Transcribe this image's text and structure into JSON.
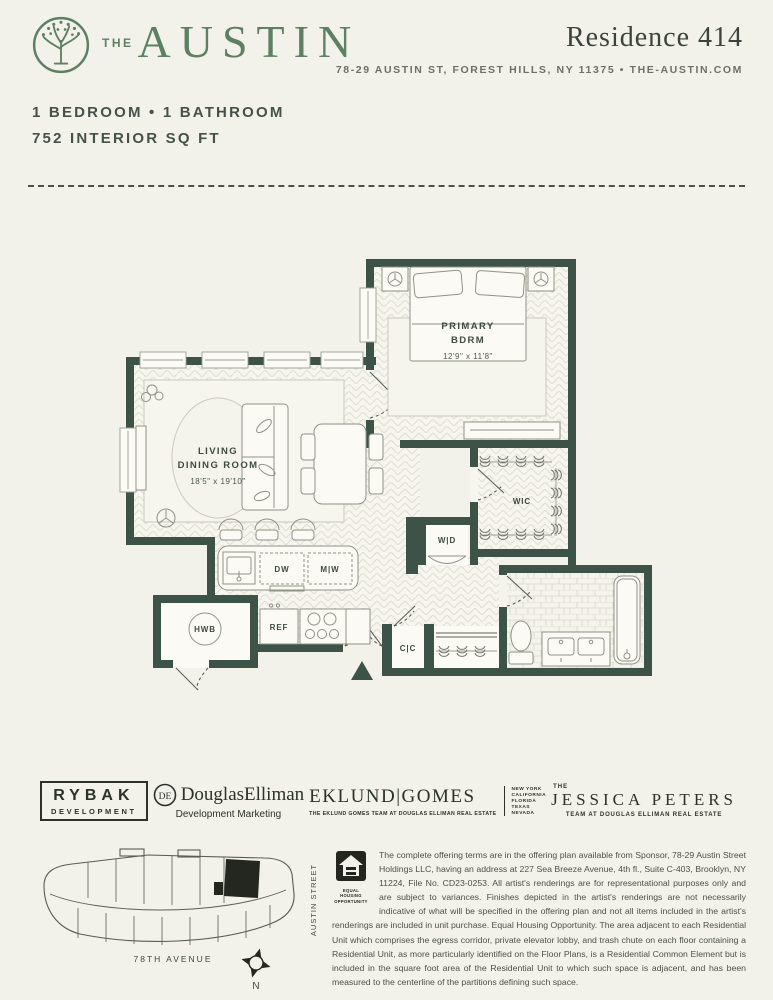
{
  "header": {
    "brand_the": "THE",
    "brand_name": "AUSTIN",
    "residence_title": "Residence 414",
    "address_line": "78-29 AUSTIN ST, FOREST HILLS, NY 11375 • THE-AUSTIN.COM"
  },
  "unit_summary": {
    "beds_baths": "1 BEDROOM  •  1 BATHROOM",
    "area": "752 INTERIOR SQ FT"
  },
  "floorplan": {
    "living_line1": "LIVING",
    "living_line2": "DINING ROOM",
    "living_dims": "18'5\" x 19'10\"",
    "bedroom_line1": "PRIMARY",
    "bedroom_line2": "BDRM",
    "bedroom_dims": "12'9\" x 11'8\"",
    "wic": "WIC",
    "washer_dryer": "W|D",
    "dishwasher": "DW",
    "microwave": "M|W",
    "hwb": "HWB",
    "refrigerator": "REF",
    "coat_closet": "C|C"
  },
  "brand_logos": {
    "rybak_line1": "RYBAK",
    "rybak_line2": "DEVELOPMENT",
    "de_monogram": "DE",
    "de_name": "DouglasElliman",
    "de_sub": "Development Marketing",
    "eklund_name": "EKLUND|GOMES",
    "eklund_sub": "THE EKLUND GOMES TEAM AT DOUGLAS ELLIMAN REAL ESTATE",
    "eklund_states": [
      "NEW YORK",
      "CALIFORNIA",
      "FLORIDA",
      "TEXAS",
      "NEVADA"
    ],
    "jp_the": "THE",
    "jp_name": "JESSICA PETERS",
    "jp_sub": "TEAM AT DOUGLAS ELLIMAN REAL ESTATE"
  },
  "sitemap": {
    "street_left": "KEW FOREST LANE",
    "street_right": "AUSTIN STREET",
    "street_bottom": "78TH AVENUE",
    "compass_label": "N"
  },
  "legal": {
    "eho_label": "EQUAL HOUSING OPPORTUNITY",
    "disclaimer": "The complete offering terms are in the offering plan available from Sponsor, 78-29 Austin Street Holdings LLC, having an address at 227 Sea Breeze Avenue, 4th fl., Suite C-403, Brooklyn, NY 11224, File No. CD23-0253. All artist's renderings are for representational purposes only and are subject to variances. Finishes depicted in the artist's renderings are not necessarily indicative of what will be specified in the offering plan and not all items included in the artist's renderings are included in unit purchase. Equal Housing Opportunity. The area adjacent to each Residential Unit which comprises the egress corridor, private elevator lobby, and trash chute on each floor containing a Residential Unit, as more particularly identified on the Floor Plans, is a Residential Common Element but is included in the square foot area of the Residential Unit to which such space is adjacent, and has been measured to the centerline of the partitions defining such space."
  },
  "colors": {
    "brand_green": "#5d8063",
    "wall_green": "#3d5348",
    "paper": "#f2f1ea",
    "ink": "#3e4a41"
  }
}
